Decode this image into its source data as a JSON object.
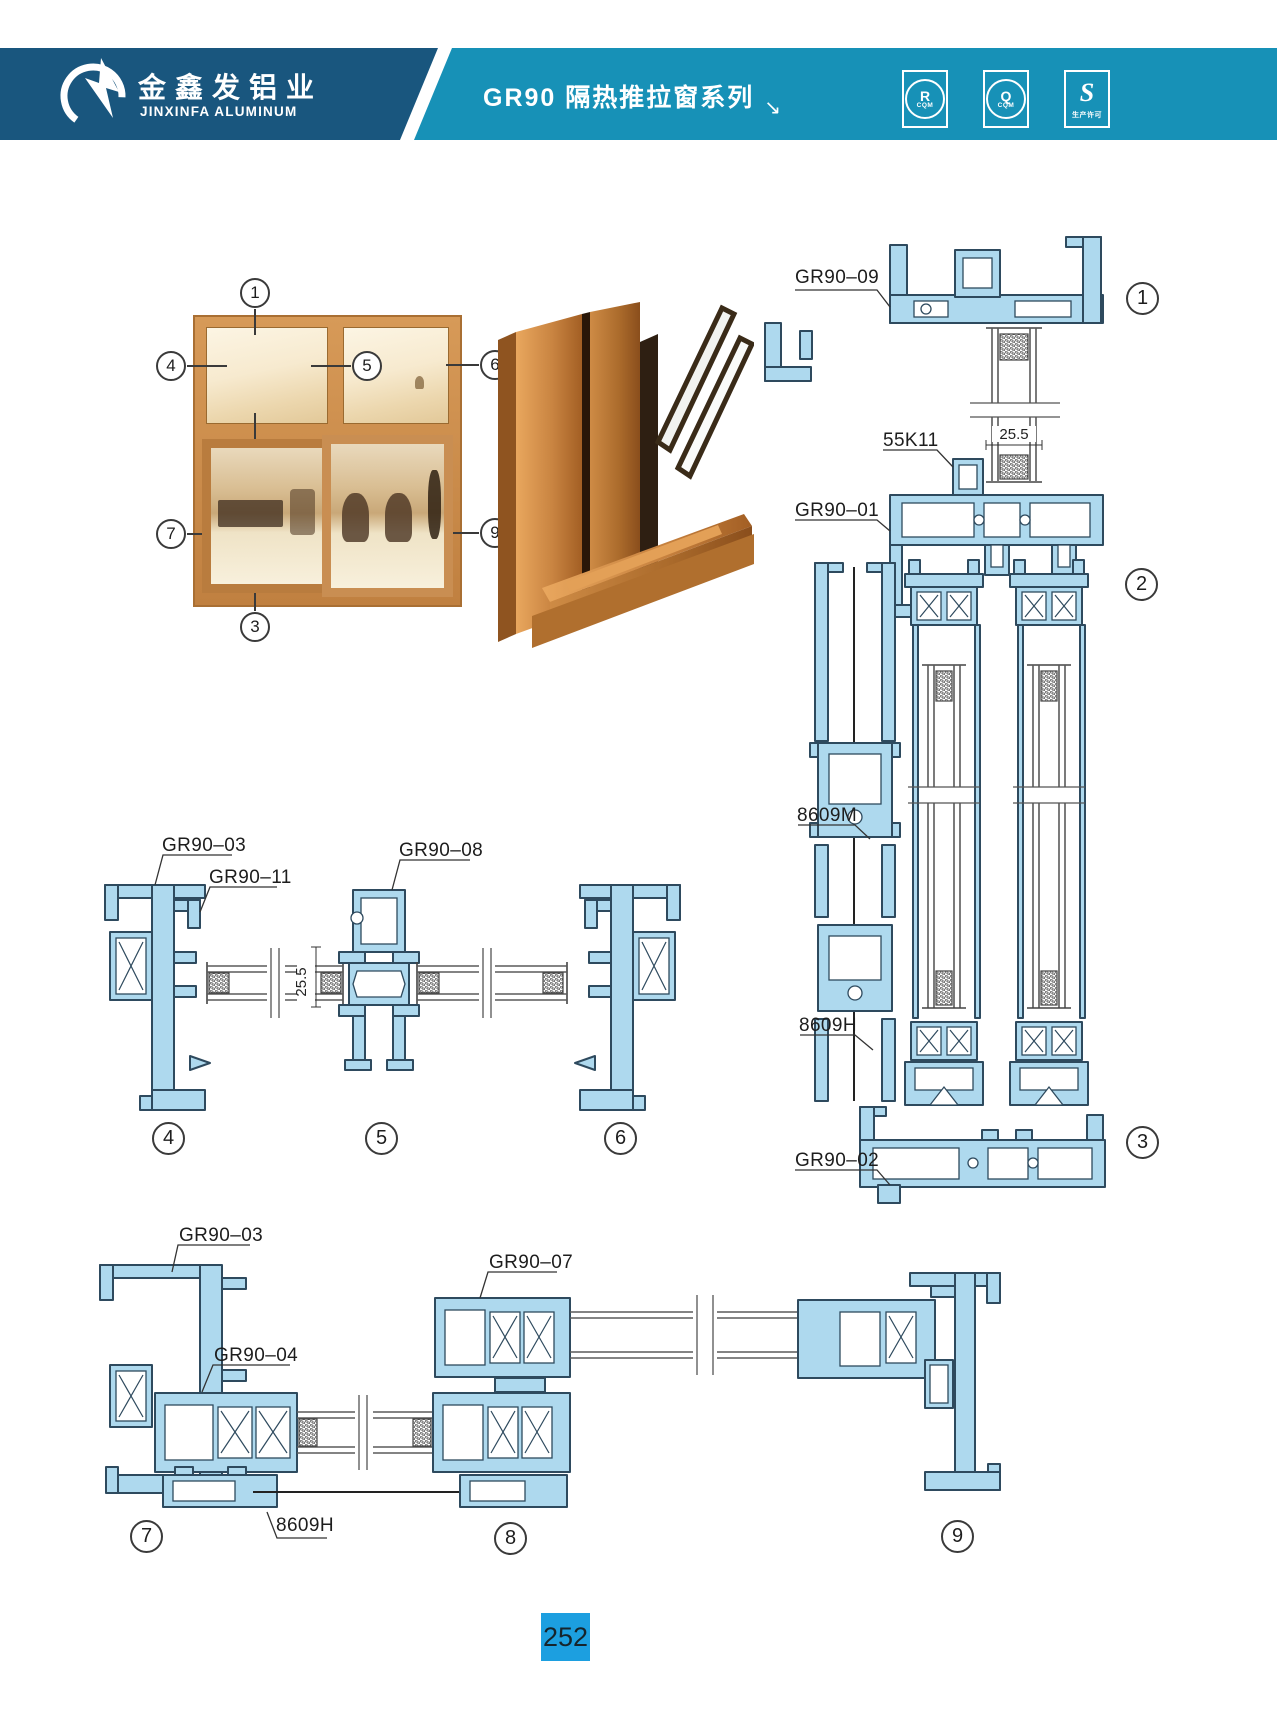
{
  "header": {
    "brand_cn": "金鑫发铝业",
    "brand_en": "JINXINFA ALUMINUM",
    "series_title": "GR90 隔热推拉窗系列",
    "series_arrow": "↘",
    "badges": [
      {
        "symbol": "R",
        "caption": "CQM"
      },
      {
        "symbol": "Q",
        "caption": "CQM"
      },
      {
        "symbol": "S",
        "caption": "生产许可"
      }
    ]
  },
  "photo_markers": [
    "1",
    "4",
    "5",
    "6",
    "2",
    "7",
    "8",
    "9",
    "3"
  ],
  "section_markers": [
    "1",
    "2",
    "3",
    "4",
    "5",
    "6",
    "7",
    "8",
    "9"
  ],
  "labels": {
    "head": "GR90–09",
    "hanger_clip": "55K11",
    "transom": "GR90–01",
    "mid_connector": "8609M",
    "bottom_connector": "8609H",
    "sill": "GR90–02",
    "jamb_mid": "GR90–03",
    "bead": "GR90–11",
    "interlock": "GR90–08",
    "jamb_bottom": "GR90–03",
    "sash": "GR90–04",
    "upper_sash": "GR90–07",
    "bottom_connector_b": "8609H",
    "glass_dim": "25.5",
    "glass_dim_v": "25.5"
  },
  "page_number": "252",
  "colors": {
    "brand_bar": "#19567E",
    "title_bar": "#1791B7",
    "page_tab": "#1C9FE0",
    "profile_fill": "#AED9EE",
    "profile_outline": "#2E4A5E",
    "wood_frame": "#C6874A"
  }
}
